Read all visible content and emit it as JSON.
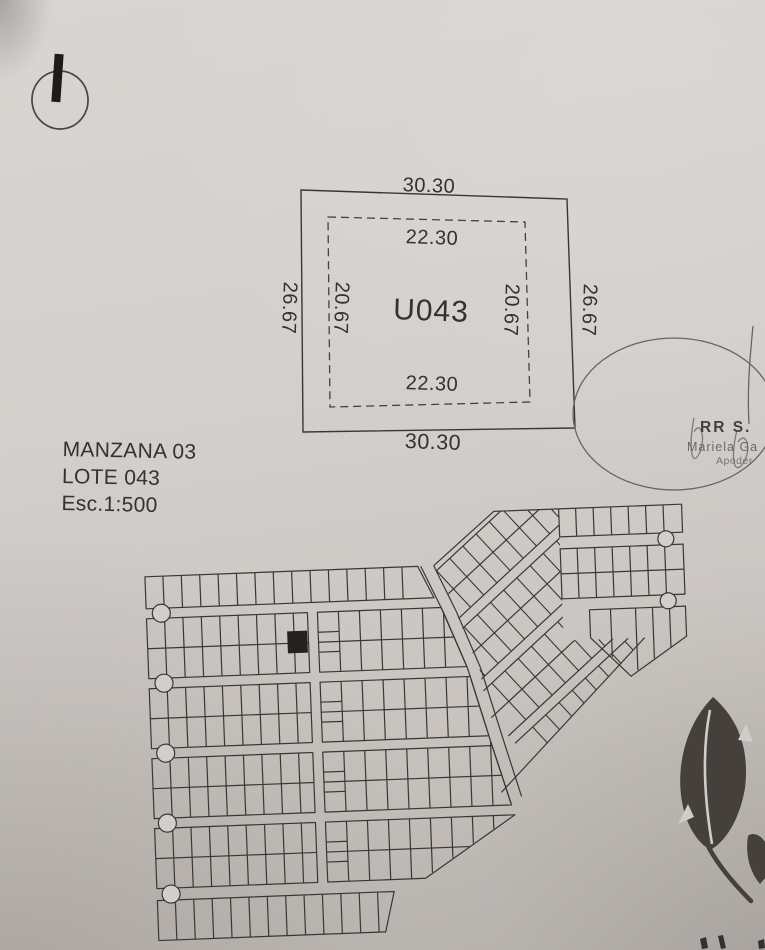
{
  "plot": {
    "code": "U043",
    "outer_top": "30.30",
    "outer_bottom": "30.30",
    "outer_left": "26.67",
    "outer_right": "26.67",
    "inner_top": "22.30",
    "inner_bottom": "22.30",
    "inner_left": "20.67",
    "inner_right": "20.67"
  },
  "info": {
    "manzana": "MANZANA 03",
    "lote": "LOTE 043",
    "escala": "Esc.1:500"
  },
  "stamp": {
    "company": "RR S.",
    "name": "Mariela Ga",
    "role": "Apoder"
  },
  "colors": {
    "paper": "#d2cecb",
    "ink": "#3a3733",
    "lot_fill": "#242120",
    "logo": "#45403c",
    "stamp_ink": "#6b655e"
  }
}
